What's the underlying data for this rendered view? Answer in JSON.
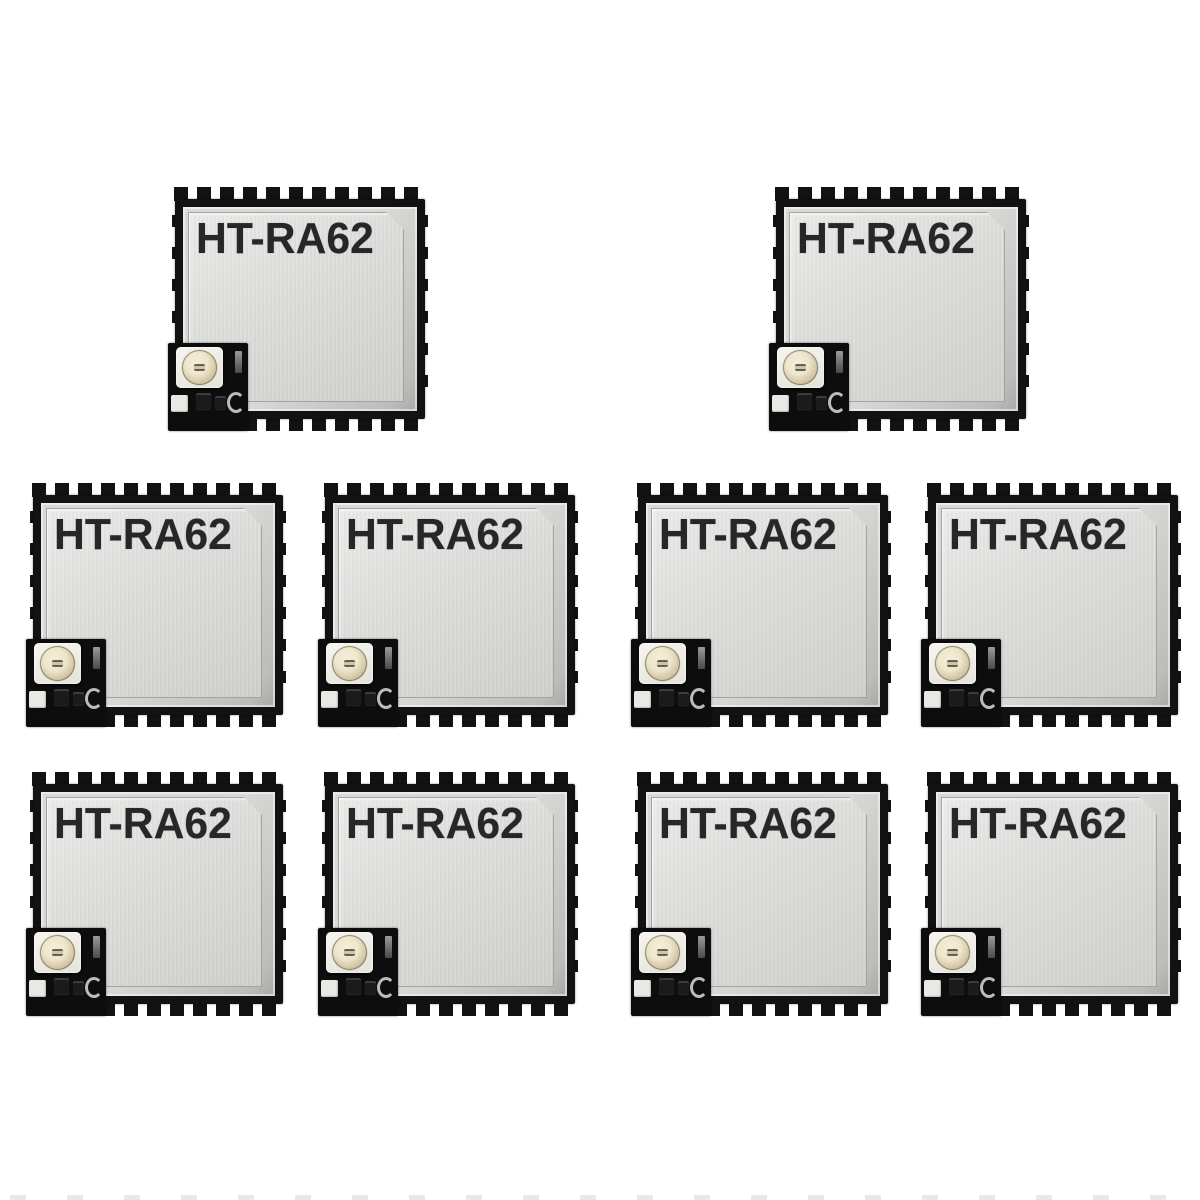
{
  "image": {
    "description": "Product photograph of ten HT-RA62 wireless RF modules with shield cans and U.FL antenna connectors arranged on a white background",
    "background_color": "#ffffff"
  },
  "module": {
    "label": "HT-RA62",
    "count": 10,
    "colors": {
      "pcb_black": "#121212",
      "shield_silver": "#dddddb",
      "shield_highlight": "#ebebe9",
      "label_text": "#272727",
      "connector_base": "#f6f5ef",
      "connector_ring": "#d2c6a3",
      "connector_center": "#f4eedc"
    }
  },
  "layout": {
    "module_width": 256,
    "module_height": 244,
    "rows": [
      {
        "y": 187,
        "modules_x": [
          172,
          773
        ]
      },
      {
        "y": 483,
        "modules_x": [
          30,
          322,
          635,
          925
        ]
      },
      {
        "y": 772,
        "modules_x": [
          30,
          322,
          635,
          925
        ]
      }
    ],
    "partial_pin_row_at_bottom_edge": true
  },
  "modules": [
    {
      "id": "module-1",
      "label": "HT-RA62"
    },
    {
      "id": "module-2",
      "label": "HT-RA62"
    },
    {
      "id": "module-3",
      "label": "HT-RA62"
    },
    {
      "id": "module-4",
      "label": "HT-RA62"
    },
    {
      "id": "module-5",
      "label": "HT-RA62"
    },
    {
      "id": "module-6",
      "label": "HT-RA62"
    },
    {
      "id": "module-7",
      "label": "HT-RA62"
    },
    {
      "id": "module-8",
      "label": "HT-RA62"
    },
    {
      "id": "module-9",
      "label": "HT-RA62"
    },
    {
      "id": "module-10",
      "label": "HT-RA62"
    }
  ]
}
